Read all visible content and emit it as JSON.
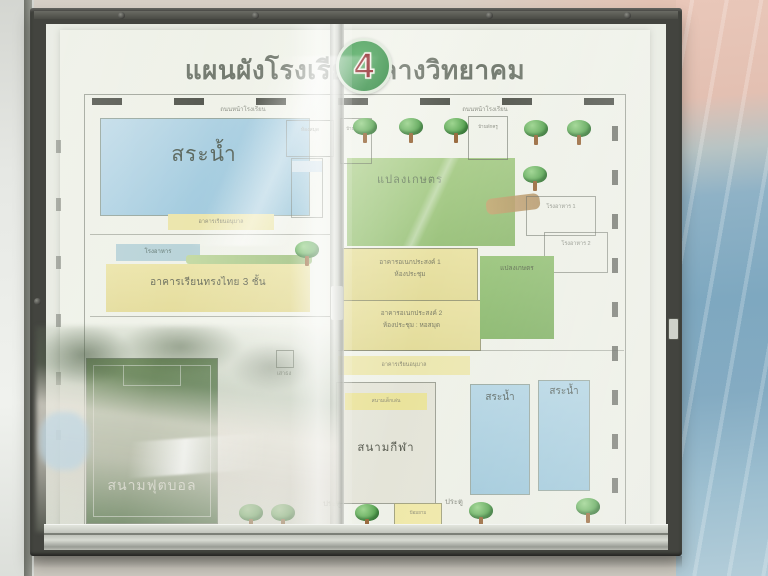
{
  "display_board": {
    "title": "แผนผังโรงเรียนกลางวิทยาคม",
    "badge_number": "4"
  },
  "map": {
    "road_label": "ถนนหน้าโรงเรียน",
    "pond_large": "สระน้ำ",
    "pond_small": "สระน้ำ",
    "library": "ห้องสมุด",
    "teacher_house": "บ้านพักครู",
    "kindergarten_strip": "อาคารเรียนอนุบาล",
    "canteen": "โรงอาหาร",
    "main_building": "อาคารเรียนทรงไทย 3 ชั้น",
    "football_field": "สนามฟุตบอล",
    "agri_plot": "แปลงเกษตร",
    "multipurpose_1_line1": "อาคารอเนกประสงค์ 1",
    "multipurpose_1_line2": "ห้องประชุม",
    "multipurpose_2_line1": "อาคารอเนกประสงค์ 2",
    "multipurpose_2_line2": "ห้องประชุม : หอสมุด",
    "playground": "สนามเด็กเล่น",
    "sports_field": "สนามกีฬา",
    "cafeteria_1": "โรงอาหาร 1",
    "cafeteria_2": "โรงอาหาร 2",
    "gate": "ประตู",
    "guard_post": "ป้อมยาม",
    "flagpole": "เสาธง"
  },
  "icons": {
    "tree": "tree-icon",
    "screw": "screw-icon"
  },
  "colors": {
    "badge_green": "#3d9a4e",
    "badge_red": "#8e2024",
    "pond_blue": "#a9cede",
    "field_green": "#8cbd70",
    "building_yellow": "#e9e2a6",
    "wall_blue": "#7ca6bf",
    "wall_pink": "#e2c0b2"
  }
}
